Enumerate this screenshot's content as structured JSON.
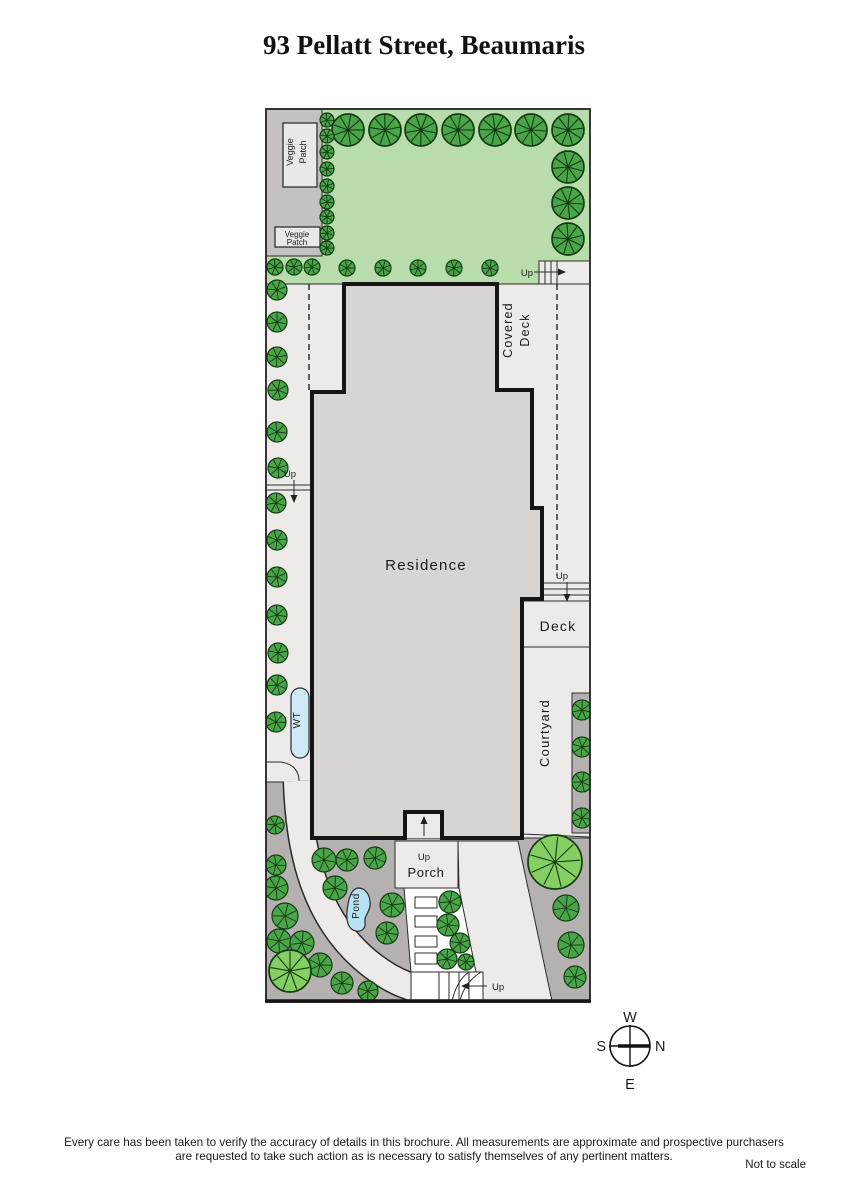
{
  "title": "93 Pellatt Street, Beaumaris",
  "labels": {
    "residence": "Residence",
    "covered_deck_1": "Covered",
    "covered_deck_2": "Deck",
    "deck": "Deck",
    "courtyard": "Courtyard",
    "porch": "Porch",
    "pond": "Pond",
    "water_tank": "WT",
    "veggie_1": "Veggie",
    "veggie_2": "Patch",
    "up": "Up"
  },
  "compass": {
    "top": "W",
    "right": "N",
    "left": "S",
    "bottom": "E"
  },
  "footer": {
    "line1": "Every care has been taken to verify the accuracy of details in this brochure.  All measurements are approximate and prospective purchasers",
    "line2": "are requested to take such action as is necessary to satisfy themselves of any pertinent matters.",
    "scale_note": "Not to scale"
  },
  "colors": {
    "lawn": "#b8dcab",
    "tree_dark": "#4aa44a",
    "tree_light": "#85ce61",
    "tree_outline": "#143c12",
    "residence": "#d7d4d1",
    "wall": "#151515",
    "light": "#ecebe9",
    "bed": "#b4b1b0",
    "strip": "#c4c1c0",
    "water": "#cfe9f7",
    "pond": "#b9e1f4",
    "white": "#ffffff",
    "line": "#2b2b2b"
  },
  "plan": {
    "trees": [
      [
        348,
        130,
        16
      ],
      [
        385,
        130,
        16
      ],
      [
        421,
        130,
        16
      ],
      [
        458,
        130,
        16
      ],
      [
        495,
        130,
        16
      ],
      [
        531,
        130,
        16
      ],
      [
        568,
        130,
        16
      ],
      [
        568,
        167,
        16
      ],
      [
        568,
        203,
        16
      ],
      [
        568,
        239,
        16
      ],
      [
        275,
        267,
        8
      ],
      [
        294,
        267,
        8
      ],
      [
        312,
        267,
        8
      ],
      [
        347,
        268,
        8
      ],
      [
        383,
        268,
        8
      ],
      [
        418,
        268,
        8
      ],
      [
        454,
        268,
        8
      ],
      [
        490,
        268,
        8
      ],
      [
        327,
        120,
        7
      ],
      [
        327,
        136,
        7
      ],
      [
        327,
        152,
        7
      ],
      [
        327,
        169,
        7
      ],
      [
        327,
        186,
        7
      ],
      [
        327,
        202,
        7
      ],
      [
        327,
        217,
        7
      ],
      [
        327,
        233,
        7
      ],
      [
        327,
        248,
        7
      ],
      [
        277,
        290,
        10
      ],
      [
        277,
        322,
        10
      ],
      [
        277,
        357,
        10
      ],
      [
        278,
        390,
        10
      ],
      [
        277,
        432,
        10
      ],
      [
        278,
        468,
        10
      ],
      [
        276,
        503,
        10
      ],
      [
        277,
        540,
        10
      ],
      [
        277,
        577,
        10
      ],
      [
        277,
        615,
        10
      ],
      [
        278,
        653,
        10
      ],
      [
        277,
        685,
        10
      ],
      [
        276,
        722,
        10
      ],
      [
        275,
        825,
        9
      ],
      [
        582,
        710,
        10
      ],
      [
        582,
        747,
        10
      ],
      [
        582,
        782,
        10
      ],
      [
        582,
        818,
        10
      ],
      [
        555,
        862,
        27,
        "l"
      ],
      [
        566,
        908,
        13
      ],
      [
        571,
        945,
        13
      ],
      [
        575,
        977,
        11
      ],
      [
        324,
        860,
        12
      ],
      [
        347,
        860,
        11
      ],
      [
        375,
        858,
        11
      ],
      [
        276,
        865,
        10
      ],
      [
        276,
        888,
        12
      ],
      [
        335,
        888,
        12
      ],
      [
        392,
        905,
        12
      ],
      [
        285,
        916,
        13
      ],
      [
        387,
        933,
        11
      ],
      [
        279,
        941,
        12
      ],
      [
        302,
        943,
        12
      ],
      [
        320,
        965,
        12
      ],
      [
        290,
        971,
        21,
        "l"
      ],
      [
        342,
        983,
        11
      ],
      [
        368,
        991,
        10
      ],
      [
        450,
        902,
        11
      ],
      [
        448,
        925,
        11
      ],
      [
        460,
        943,
        10
      ],
      [
        447,
        959,
        10
      ],
      [
        466,
        962,
        8
      ]
    ],
    "stones": [
      [
        415,
        897,
        22,
        11
      ],
      [
        415,
        916,
        22,
        11
      ],
      [
        415,
        936,
        22,
        11
      ],
      [
        415,
        953,
        22,
        11
      ]
    ]
  }
}
